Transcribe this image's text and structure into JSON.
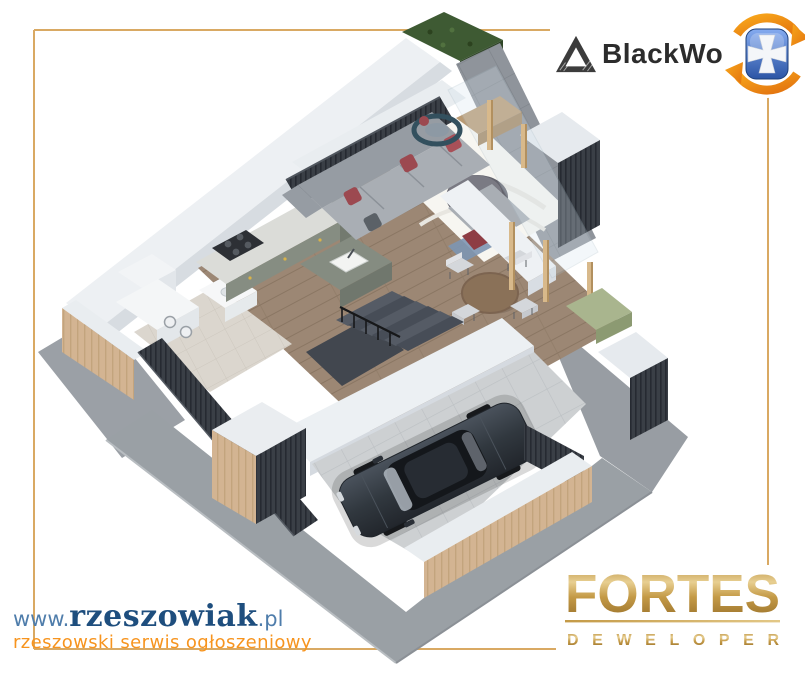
{
  "branding": {
    "blackwood": {
      "wordmark": "BlackWo",
      "logo_icon": "mountain-triangle-logo",
      "badge_icon": "shield-cross-circular-arrows-badge",
      "text_color": "#2c2c2c",
      "badge_blue": "#2c55a5",
      "badge_orange": "#ef8f1d"
    },
    "rzeszowiak": {
      "prefix": "www.",
      "name": "rzeszowiak",
      "suffix": ".pl",
      "tagline": "rzeszowski serwis ogłoszeniowy",
      "name_color": "#1e4e7e",
      "prefix_color": "#4f7dab",
      "tagline_color": "#f7941e"
    },
    "fortes": {
      "wordmark": "FORTES",
      "subtitle": "DEWELOPER",
      "gold_color": "#b98f3f"
    }
  },
  "frame": {
    "color": "#d9a963"
  },
  "scene": {
    "description": "3D isometric cutaway render of a house ground floor with living room, kitchen, dining area, bathroom, stairs and garage with a dark sedan",
    "palette": {
      "wall_white": "#edf0f3",
      "wood_floor": "#9c8774",
      "slat_dark": "#3a3f46",
      "hedge_green": "#3e5a33",
      "terrace_tile": "#8f949b",
      "garage_floor": "#cdd0d2",
      "wood_cladding": "#d3b492",
      "sofa_gray": "#a9aeb4",
      "pillow_maroon": "#9c4950",
      "car_dark": "#2b3139",
      "concrete_path": "#9aa0a5"
    }
  }
}
